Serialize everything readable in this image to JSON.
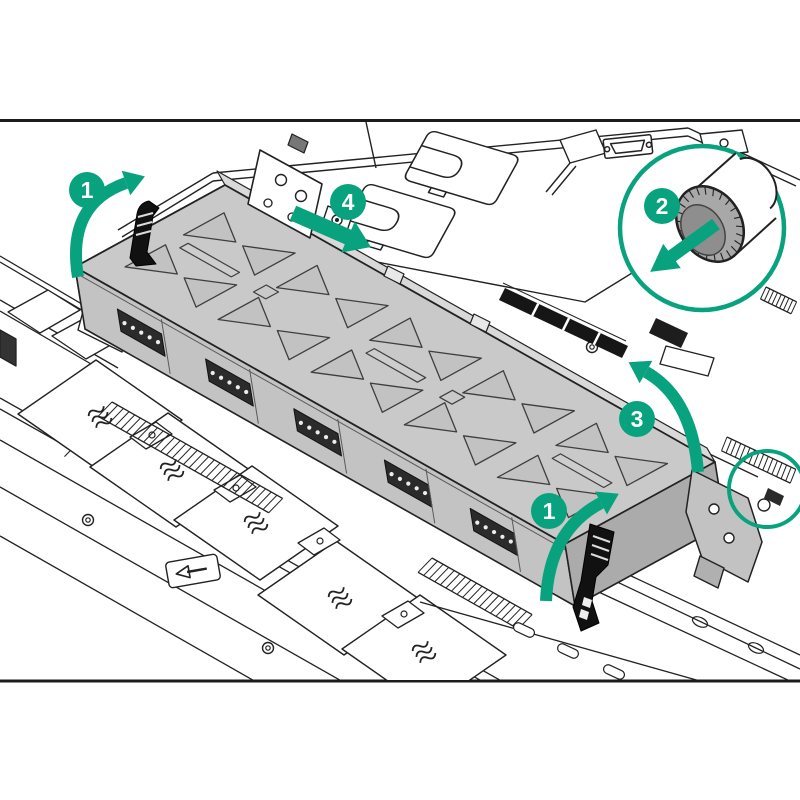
{
  "colors": {
    "accent": "#08a37e",
    "line": "#222222",
    "background": "#ffffff",
    "cage_fill": "#c9c9c9",
    "cage_front_fill": "#c3c3c3",
    "metal_gray": "#a8a8a8"
  },
  "callouts": [
    {
      "id": "step-1-left",
      "label": "1"
    },
    {
      "id": "step-4",
      "label": "4"
    },
    {
      "id": "step-2",
      "label": "2"
    },
    {
      "id": "step-3",
      "label": "3"
    },
    {
      "id": "step-1-right",
      "label": "1"
    }
  ]
}
